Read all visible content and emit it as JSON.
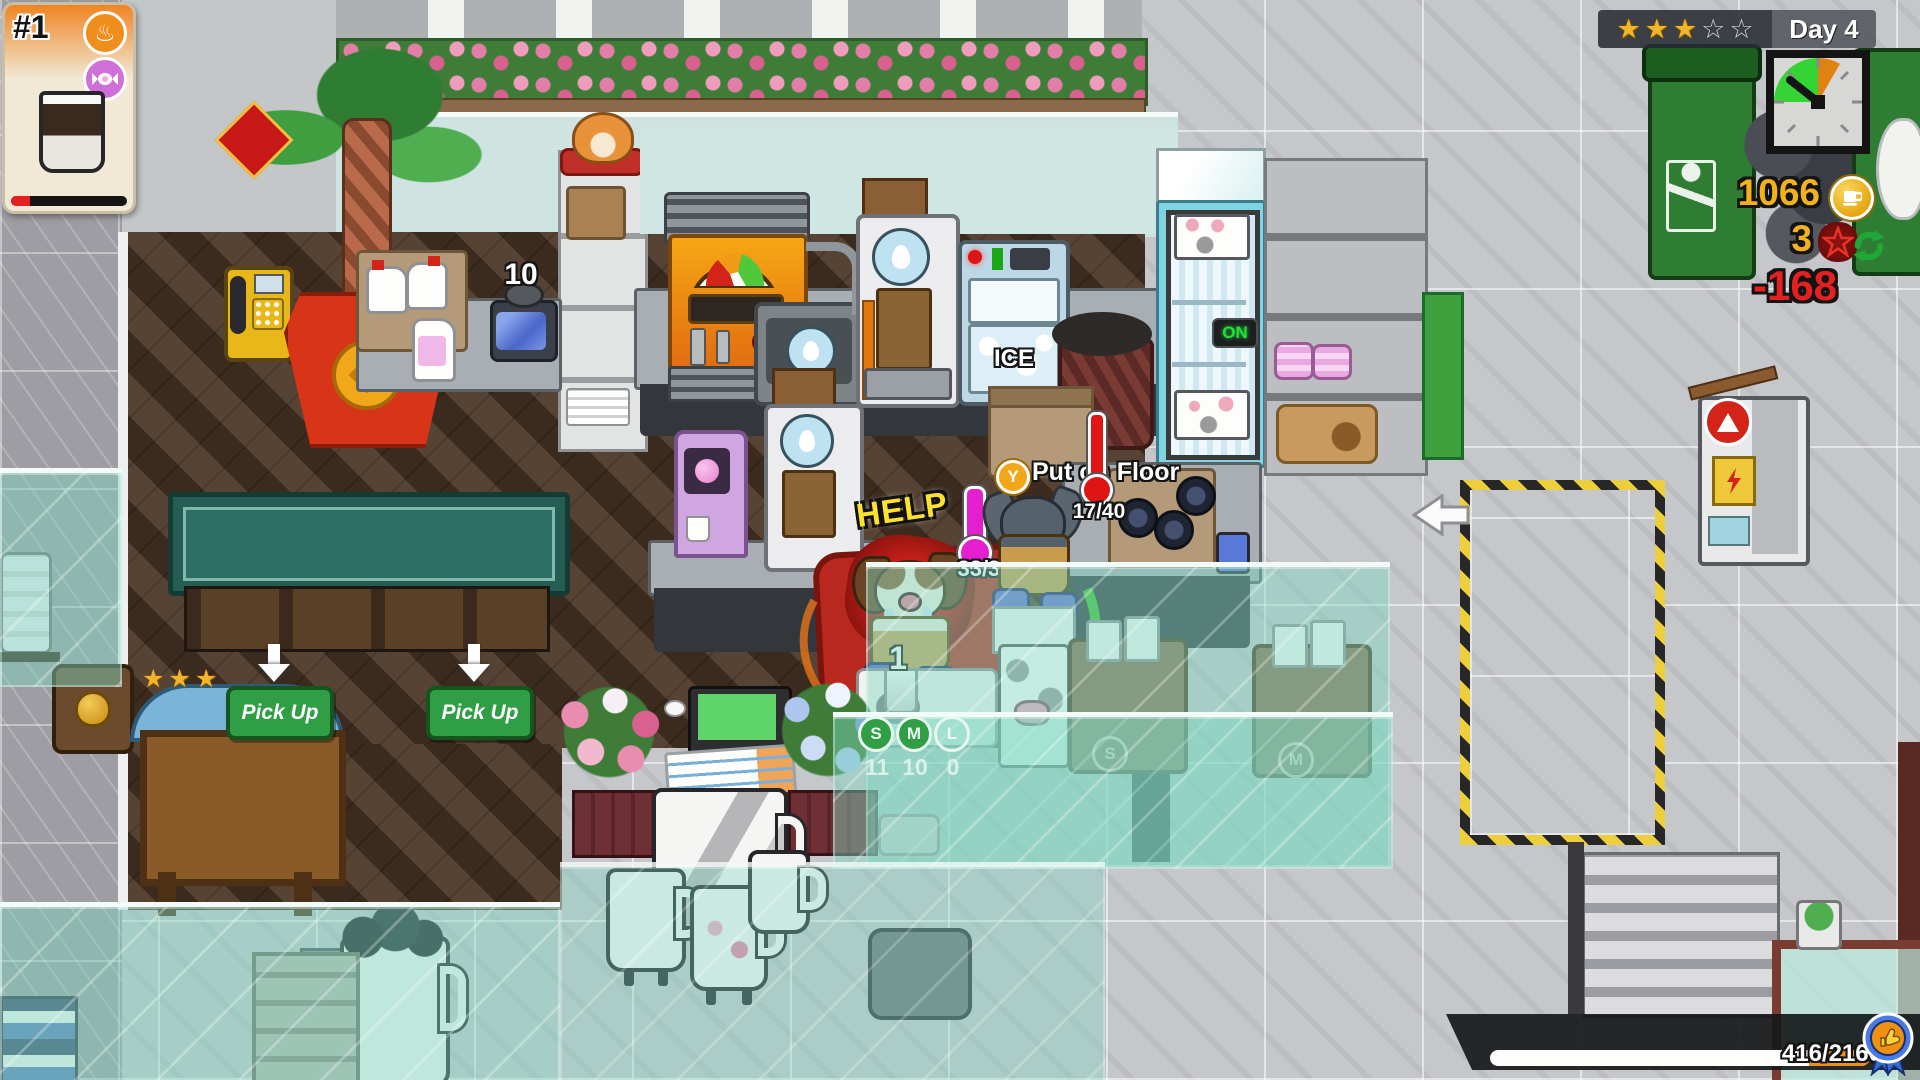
{
  "hud": {
    "order_card": {
      "number": "#1",
      "tag_icons": [
        "hot-spring",
        "candy"
      ],
      "item": "coffee-cup",
      "patience_fraction": 0.16
    },
    "rating": {
      "stars": [
        "★",
        "★",
        "★",
        "☆",
        "☆"
      ],
      "day": "Day 4"
    },
    "coins": "1066",
    "pentagram_count": "3",
    "money_delta": "-168",
    "xp": {
      "label": "416/2160",
      "current": 416,
      "max": 2160,
      "white_fraction": 0.84,
      "orange_fraction": 0.16
    }
  },
  "scene": {
    "help_bubble": "HELP",
    "carried_temp": "33/32",
    "floor_prompt": {
      "button": "Y",
      "label": "Put on Floor",
      "count": "17/40"
    },
    "pickup_sign": "Pick Up",
    "syrup_can_count": "10",
    "cup_station_count": "1",
    "cup_sizes": [
      {
        "label": "S",
        "count": "11"
      },
      {
        "label": "M",
        "count": "10"
      },
      {
        "label": "L",
        "count": "0"
      }
    ],
    "fridge_power": "ON",
    "ice_machine_label": "ICE",
    "dish_machine_labels": [
      "S",
      "M"
    ]
  },
  "colors": {
    "coin_gold": "#f3b21c",
    "loss_red": "#e62020",
    "pickup_green": "#2f9e44",
    "clock_green": "#35d435",
    "clock_orange": "#e0820f",
    "help_yellow": "#ffe22e",
    "thermo_magenta": "#e41fd0",
    "thermo_red": "#e01414"
  }
}
